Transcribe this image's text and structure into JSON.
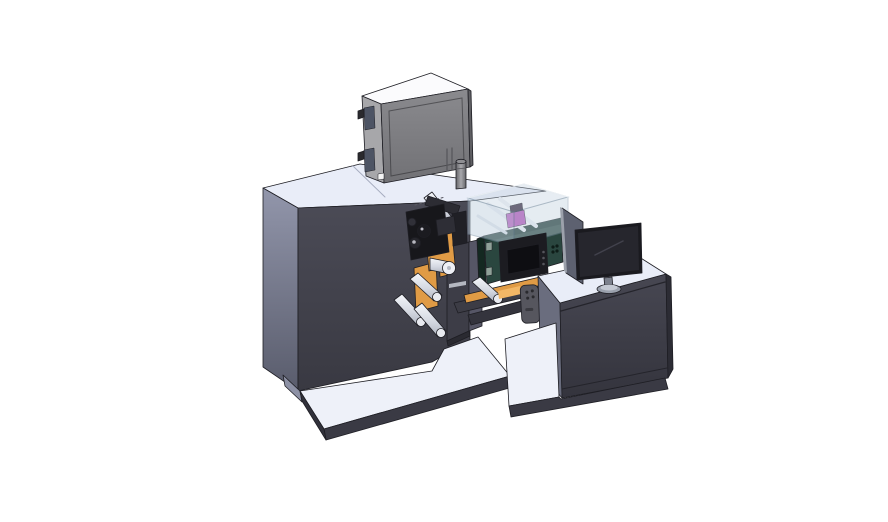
{
  "canvas": {
    "width": 888,
    "height": 522,
    "background": "#ffffff"
  },
  "scene": {
    "render_type": "3d-cad-isometric-render",
    "subject": "industrial roll-fed label printing machine with operator console",
    "components": [
      {
        "id": "main-cabinet",
        "label": "main machine cabinet"
      },
      {
        "id": "electrical-box",
        "label": "electrical enclosure on machine top"
      },
      {
        "id": "vent-cylinder",
        "label": "cylindrical vent / filter"
      },
      {
        "id": "unwind-station",
        "label": "web unwind station with guide rollers"
      },
      {
        "id": "printhead-assembly",
        "label": "print head mechanism"
      },
      {
        "id": "print-engine",
        "label": "print engine with clear acrylic cover"
      },
      {
        "id": "hmi-panel",
        "label": "small HMI display on print engine"
      },
      {
        "id": "conveyor-arm",
        "label": "outfeed conveyor arm"
      },
      {
        "id": "pendant-remote",
        "label": "hand-held pendant control"
      },
      {
        "id": "control-desk",
        "label": "operator control desk"
      },
      {
        "id": "monitor",
        "label": "desktop monitor on stand"
      },
      {
        "id": "rear-panel",
        "label": "second display panel seen edge-on"
      },
      {
        "id": "machine-base",
        "label": "machine base platform"
      },
      {
        "id": "desk-base",
        "label": "desk base platform"
      }
    ]
  },
  "colors": {
    "background": "#ffffff",
    "edge": "#1e1e24",
    "cabinet_front": "#45454f",
    "cabinet_front_dark": "#3a3a43",
    "cabinet_side_light": "#9296ab",
    "cabinet_side_dark": "#595c6c",
    "surface_pale": "#e9edf8",
    "platform_pale": "#eef1f9",
    "platform_edge": "#3a3a44",
    "box_top": "#fbfbfd",
    "box_front": "#7e7e82",
    "box_side": "#a7a7aa",
    "box_window": "#4d5464",
    "box_window_frame": "#a0a3ab",
    "roller_light": "#f2f4f8",
    "roller_mid": "#b9bec9",
    "orange": "#e09b45",
    "orange_light": "#f2b766",
    "station_panel": "#3d3d47",
    "station_panel_light": "#565666",
    "printhead_black": "#17171b",
    "printhead_gray": "#2c2c33",
    "green_unit": "#2a463f",
    "green_unit_dark": "#142821",
    "acrylic": "#c2d2e0",
    "acrylic_edge": "#7d93a6",
    "magenta": "#b44cb8",
    "panel_bezel": "#1c1c21",
    "panel_screen": "#0e0e12",
    "monitor_bezel": "#1a1a1f",
    "monitor_screen": "#26262d",
    "monitor_stand": "#9aa0ac",
    "rear_panel": "#5d6170",
    "pendant": "#56565e",
    "desk_front": "#42424c"
  }
}
